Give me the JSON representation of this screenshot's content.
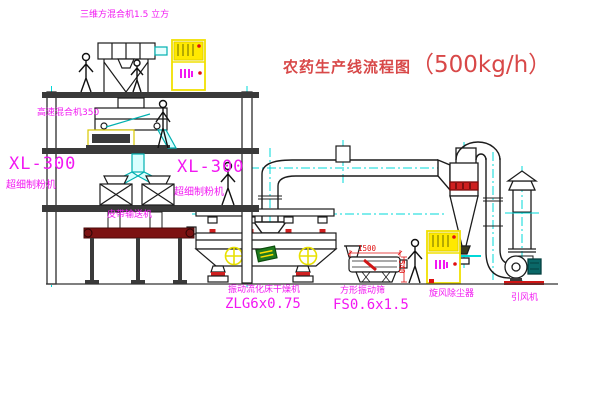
{
  "title": {
    "text_cn": "农药生产线流程图",
    "text_capacity": "（500kg/h）"
  },
  "equipment_labels": {
    "three_d_mixer": "三维方混合机1.5 立方",
    "high_speed_mixer": "高速混合机350",
    "mill_left_model": "XL-300",
    "mill_left_name": "超细制粉机",
    "mill_center_model": "XL-300",
    "mill_center_name": "超细制粉机",
    "belt_conveyor": "皮带输送机",
    "fluid_bed_dryer_name": "振动流化床干燥机",
    "fluid_bed_dryer_model": "ZLG6x0.75",
    "square_sieve_name": "方形振动筛",
    "square_sieve_model": "FS0.6x1.5",
    "cyclone": "旋风除尘器",
    "induced_draft_fan": "引风机"
  },
  "dimensions": {
    "sieve_length": "1500",
    "sieve_height": "540"
  },
  "colors": {
    "line": "#1c1c1c",
    "centerline_cyan": "#00d8d8",
    "label_magenta": "#f218f2",
    "title_red": "#d84848",
    "dimension_red": "#e01010",
    "cabinet_yellow": "#f0e000",
    "conveyor_dark_red": "#7c1212"
  }
}
